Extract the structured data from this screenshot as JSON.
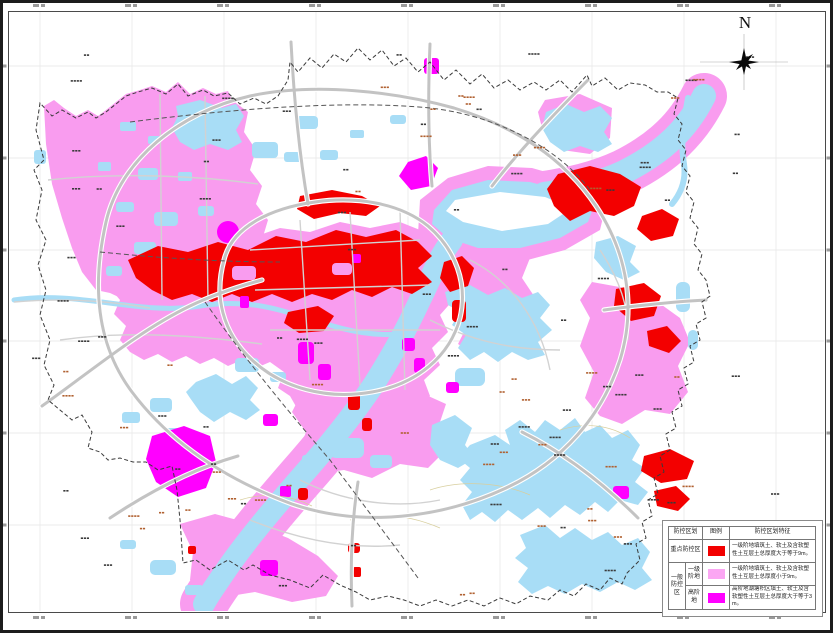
{
  "compass": {
    "label": "N"
  },
  "legend": {
    "col_zone": "防控区划",
    "col_symbol": "图例",
    "col_feature": "防控区划特征",
    "row_key": {
      "zone": "重点防控区",
      "color": "#f30000",
      "desc": "一级阶地填筑土、软土及含软塑性土互层土总厚度大于等于9m。"
    },
    "row_general_group": "一般防控区",
    "row_terrace": {
      "zone": "一级阶地",
      "color": "#fba6f3",
      "desc": "一级阶地填筑土、软土及含软塑性土互层土总厚度小于9m。"
    },
    "row_high": {
      "zone": "高阶地",
      "color": "#ff00ff",
      "desc": "高阶地湖塘积区填土、软土及含软塑性土互层土总厚度大于等于3m。"
    }
  },
  "map_colors": {
    "key_zone_red": "#f30000",
    "terrace_pink": "#f99cef",
    "high_terrace_magenta": "#ff00ff",
    "water_blue": "#a8ddf6",
    "road_gray": "#c3c3c3",
    "boundary_gray": "#3a3a3a",
    "grid_gray": "#ebebeb"
  }
}
